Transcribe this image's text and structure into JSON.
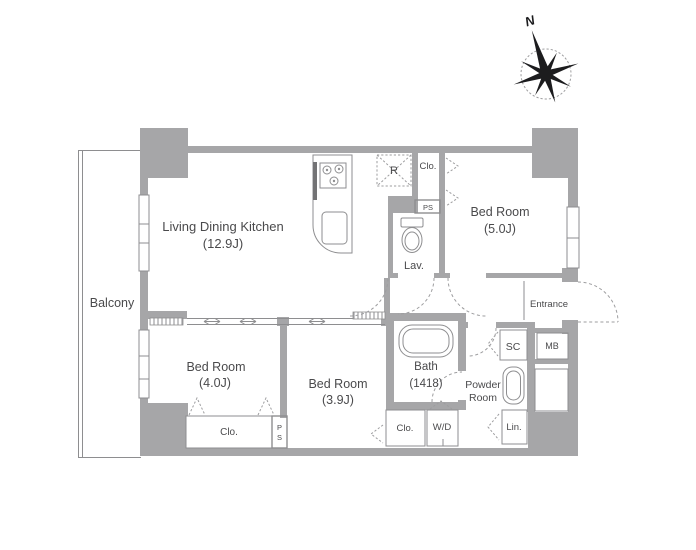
{
  "plan": {
    "compass_north": "N",
    "balcony": "Balcony",
    "ldk": {
      "name": "Living Dining Kitchen",
      "size": "(12.9J)"
    },
    "bedroom_5": {
      "name": "Bed Room",
      "size": "(5.0J)"
    },
    "bedroom_4": {
      "name": "Bed Room",
      "size": "(4.0J)"
    },
    "bedroom_3": {
      "name": "Bed Room",
      "size": "(3.9J)"
    },
    "bath": {
      "name": "Bath",
      "size": "(1418)"
    },
    "lavatory": "Lav.",
    "powder_room": {
      "line1": "Powder",
      "line2": "Room"
    },
    "entrance": "Entrance",
    "refrigerator": "R",
    "closet_top": "Clo.",
    "closet_bedroom4": "Clo.",
    "closet_mid": "Clo.",
    "pipe_space_top": "PS",
    "pipe_space_p": "P",
    "pipe_space_s": "S",
    "shoe_closet": "SC",
    "mail_box": "MB",
    "washer_dryer": "W/D",
    "linen": "Lin."
  },
  "colors": {
    "wall": "#a6a6a8",
    "thin_line": "#8e8e90",
    "dashed_line": "#9d9d9f",
    "text": "#4a4a4c",
    "compass": "#1c1c1e",
    "background": "#ffffff"
  }
}
